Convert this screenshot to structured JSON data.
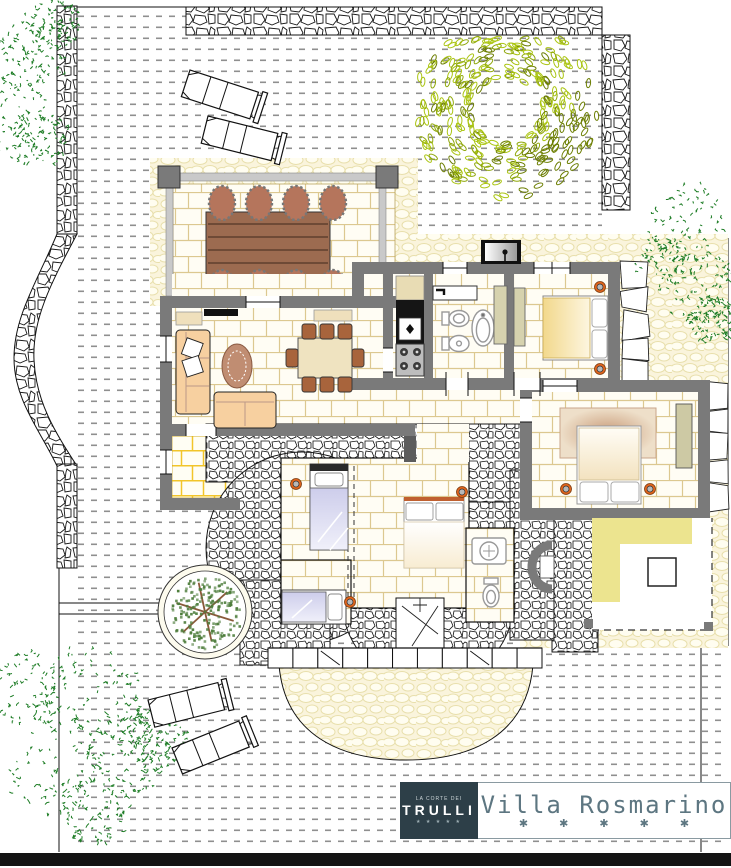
{
  "brand": {
    "logo_top": "LA CORTE DEI",
    "logo_name": "TRULLI",
    "logo_stars": "★ ★ ★ ★ ★",
    "title": "Villa Rosmarino",
    "title_stars": "✱ ✱ ✱ ✱ ✱"
  },
  "palette": {
    "wall": "#7a7a7a",
    "wall_dark": "#5c5c5c",
    "stone_stroke": "#161616",
    "dots": "#8f8f8f",
    "cobble_bg": "#faf4dc",
    "cobble_stroke": "#e8dfab",
    "tile_stroke": "#dcc890",
    "ytile_stroke": "#f2c52a",
    "floor": "#fffdf4",
    "tree_green": "#1e7d26",
    "ring_light": "#abc513",
    "ring_mid": "#8fa70c",
    "ring_dark": "#6d7f04",
    "bush": "#4c7c3a",
    "branch": "#8a5a3a",
    "lamp": "#e2651c",
    "sofa": "#f7d0a0",
    "wood": "#9c6b50",
    "wood_dark": "#6e4a36",
    "chair_veranda": "#b5755c",
    "chair_dining": "#a8643c",
    "cream_table": "#efe3c0",
    "cabinet": "#d6d2ae",
    "bed_warm": "#f2d88c",
    "bed_cool": "#b9b9df",
    "rug": "#d9b897",
    "rug_oval": "#c08d72",
    "pergola_yellow": "#ece48f",
    "logo_bg": "#2d3f48",
    "brand_text": "#5d7681",
    "bar": "#141414"
  }
}
